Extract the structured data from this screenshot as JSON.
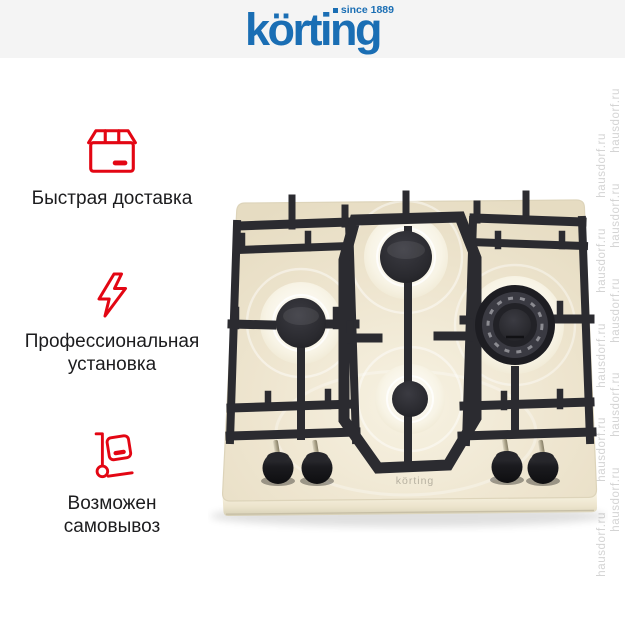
{
  "header": {
    "brand": "körting",
    "since": "since 1889"
  },
  "features": [
    {
      "icon": "package-icon",
      "label": "Быстрая доставка"
    },
    {
      "icon": "lightning-icon",
      "label": "Профессиональная установка"
    },
    {
      "icon": "handtruck-icon",
      "label": "Возможен самовывоз"
    }
  ],
  "watermark": {
    "text": "hausdorf.ru"
  },
  "product": {
    "brand_engraving": "körting",
    "description": "beige gas hob, 4 burners, black cast-iron grates, 4 black knobs"
  },
  "colors": {
    "brand_blue": "#1a6eb4",
    "accent_red": "#e30613",
    "header_band": "#f4f4f4",
    "hob_cream": "#ece3cc",
    "grate_black": "#2b2b30",
    "watermark_gray": "#d4d4d4",
    "text_dark": "#1c1c1e"
  }
}
